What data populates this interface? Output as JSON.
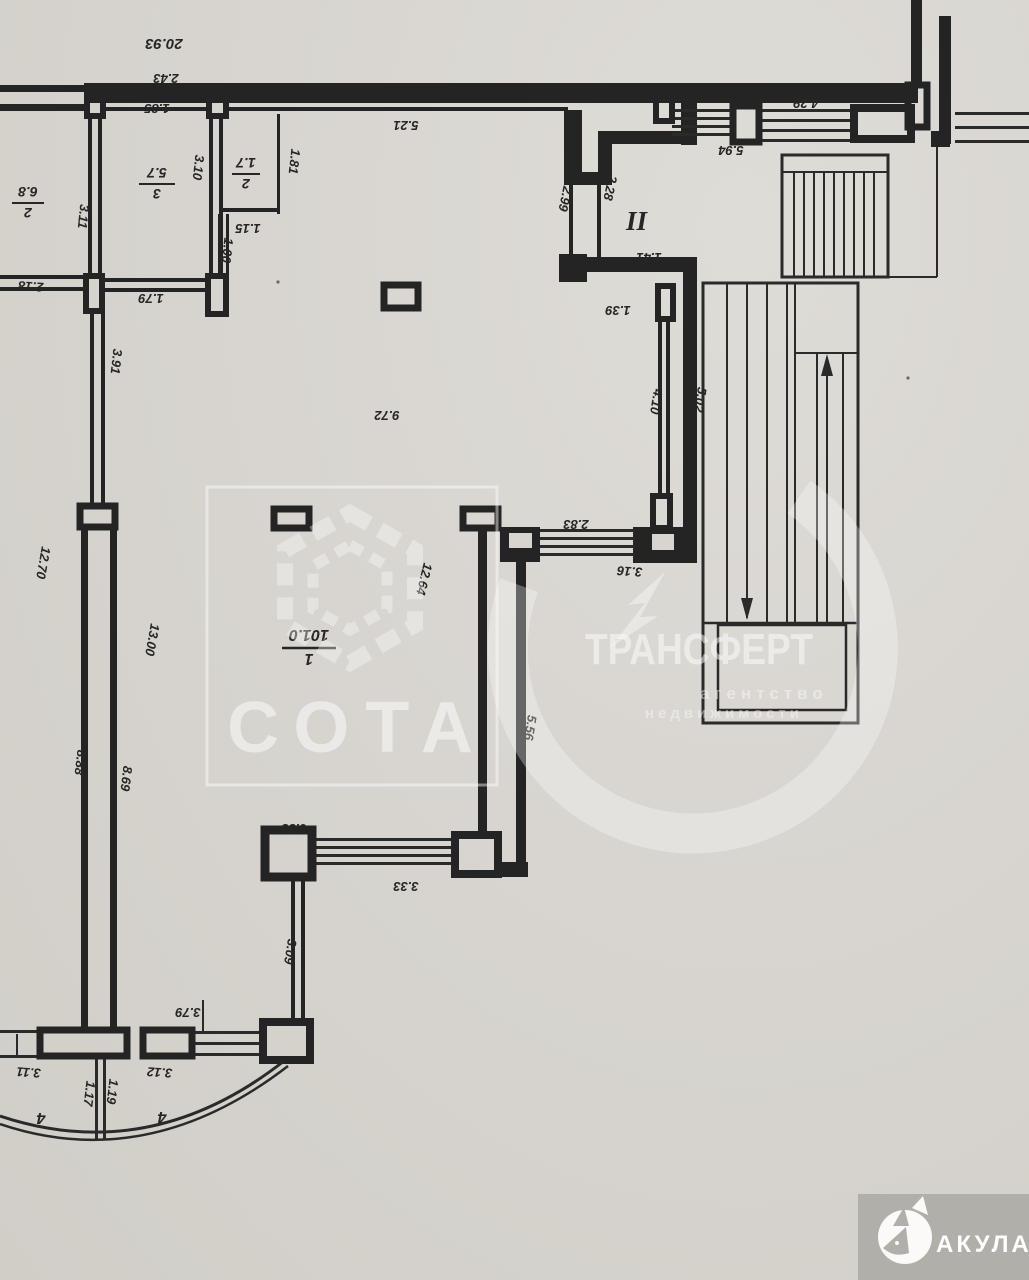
{
  "page": {
    "type": "scanned floor plan, rotated 180°"
  },
  "dimensions": {
    "d20_93": "20.93",
    "d2_43": "2.43",
    "d1_85": "1.85",
    "d5_21": "5.21",
    "d3_10": "3.10",
    "d1_81": "1.81",
    "d1_15": "1.15",
    "d1_00": "1.00",
    "d3_11a": "3.11",
    "d2_18": "2.18",
    "d1_79": "1.79",
    "d3_91": "3.91",
    "d2_99": "2.99",
    "d2_28": "2.28",
    "d1_41": "1.41",
    "d1_39": "1.39",
    "d5_94": "5.94",
    "d4_29": "4.29",
    "d4_10": "4.10",
    "d5_02": "5.02",
    "d9_72": "9.72",
    "d12_64": "12.64",
    "d2_83": "2.83",
    "d3_16": "3.16",
    "d12_70": "12.70",
    "d13_00": "13.00",
    "d8_88": "8.88",
    "d8_69": "8.69",
    "d5_56": "5.56",
    "d6_53": "6.53",
    "d3_33": "3.33",
    "d3_09": "3.09",
    "d3_79": "3.79",
    "d3_12": "3.12",
    "d3_11b": "3.11",
    "d1_17": "1.17",
    "d1_19": "1.19"
  },
  "rooms": {
    "r1": {
      "number": "1",
      "area": "101.0"
    },
    "r2": {
      "number": "2",
      "area": "6.8"
    },
    "r3": {
      "number": "3",
      "area": "5.7"
    },
    "r2s": {
      "number": "2",
      "area": "1.7"
    },
    "r4a": {
      "number": "4"
    },
    "r4b": {
      "number": "4"
    },
    "stairwell_mark": "II"
  },
  "watermarks": {
    "sota": {
      "title": "СОТА"
    },
    "transfert": {
      "title": "ТРАНСФЕРТ",
      "line1": "агентство",
      "line2": "недвижимости"
    }
  },
  "badge": {
    "label": "АКУЛА"
  },
  "colors": {
    "paper": "#d8d5d0",
    "ink": "#242424",
    "watermark": "#ffffff",
    "badge_bg": "#b1afa9"
  }
}
